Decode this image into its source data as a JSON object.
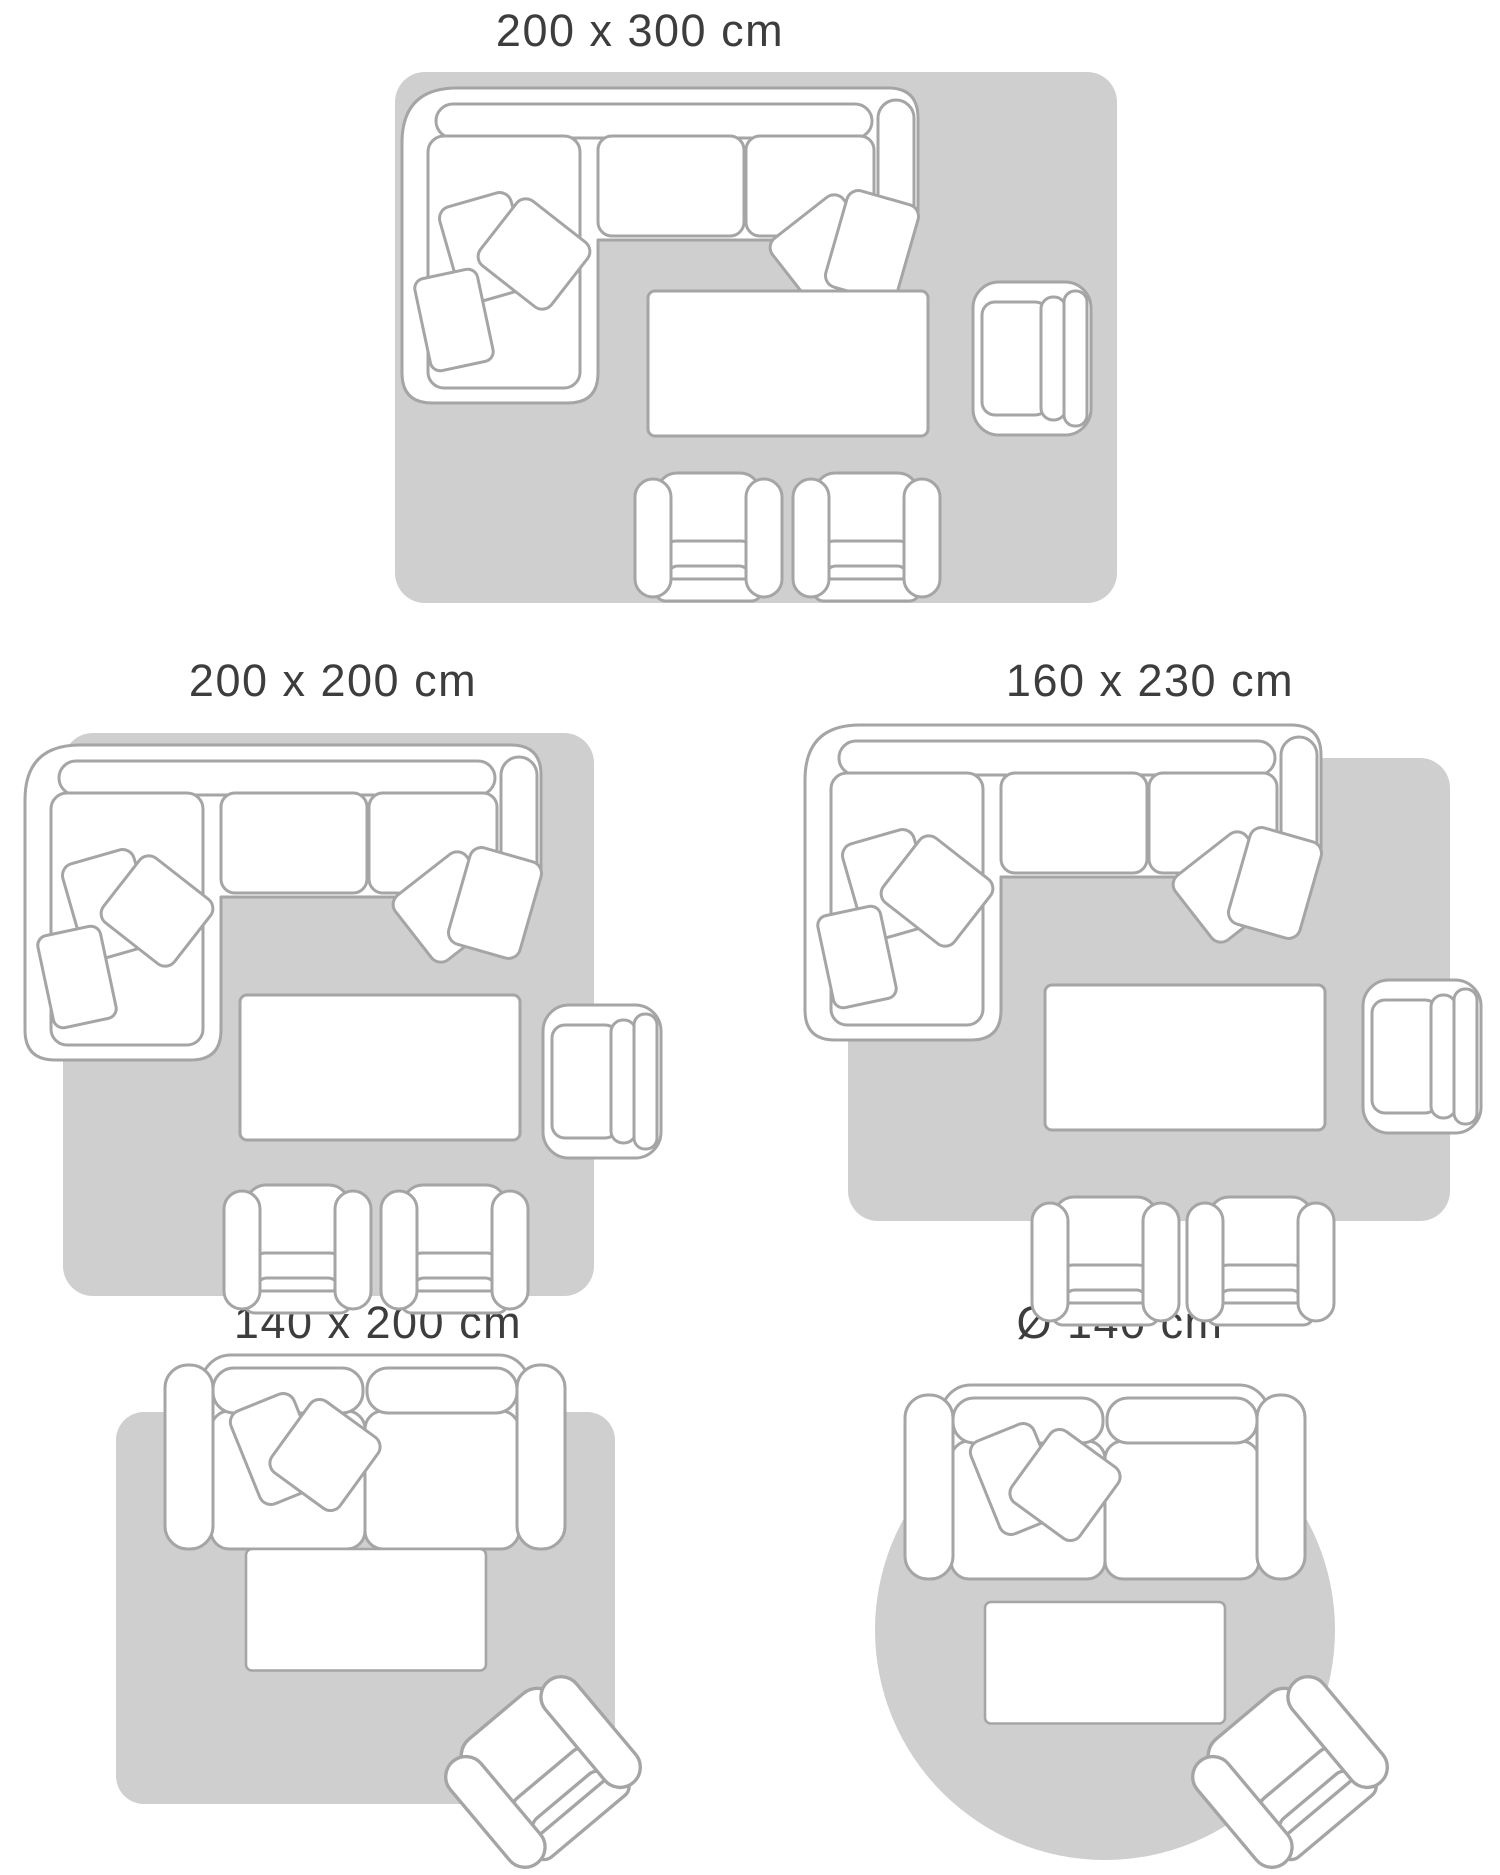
{
  "colors": {
    "page": "#ffffff",
    "rug": "#cfcfcf",
    "line": "#a5a5a5",
    "furnfill": "#ffffff",
    "title": "#3d3d3d"
  },
  "diagrams": [
    {
      "id": "200x300",
      "title": "200 x 300 cm",
      "rug": {
        "shape": "rectangle",
        "width_cm": 200,
        "length_cm": 300
      },
      "furniture": [
        "corner-sofa-with-cushions",
        "coffee-table",
        "armchair",
        "club-chair",
        "club-chair"
      ]
    },
    {
      "id": "200x200",
      "title": "200 x 200 cm",
      "rug": {
        "shape": "square",
        "width_cm": 200,
        "length_cm": 200
      },
      "furniture": [
        "corner-sofa-with-cushions",
        "coffee-table",
        "armchair",
        "club-chair",
        "club-chair"
      ]
    },
    {
      "id": "160x230",
      "title": "160 x 230 cm",
      "rug": {
        "shape": "rectangle",
        "width_cm": 160,
        "length_cm": 230
      },
      "furniture": [
        "corner-sofa-with-cushions",
        "coffee-table",
        "armchair",
        "club-chair",
        "club-chair"
      ]
    },
    {
      "id": "140x200",
      "title": "140 x 200 cm",
      "rug": {
        "shape": "rectangle",
        "width_cm": 140,
        "length_cm": 200
      },
      "furniture": [
        "two-seat-sofa-with-cushions",
        "coffee-table",
        "angled-armchair"
      ]
    },
    {
      "id": "round140",
      "title": "Ø 140 cm",
      "rug": {
        "shape": "circle",
        "diameter_cm": 140
      },
      "furniture": [
        "two-seat-sofa-with-cushions",
        "coffee-table",
        "angled-armchair"
      ]
    }
  ]
}
